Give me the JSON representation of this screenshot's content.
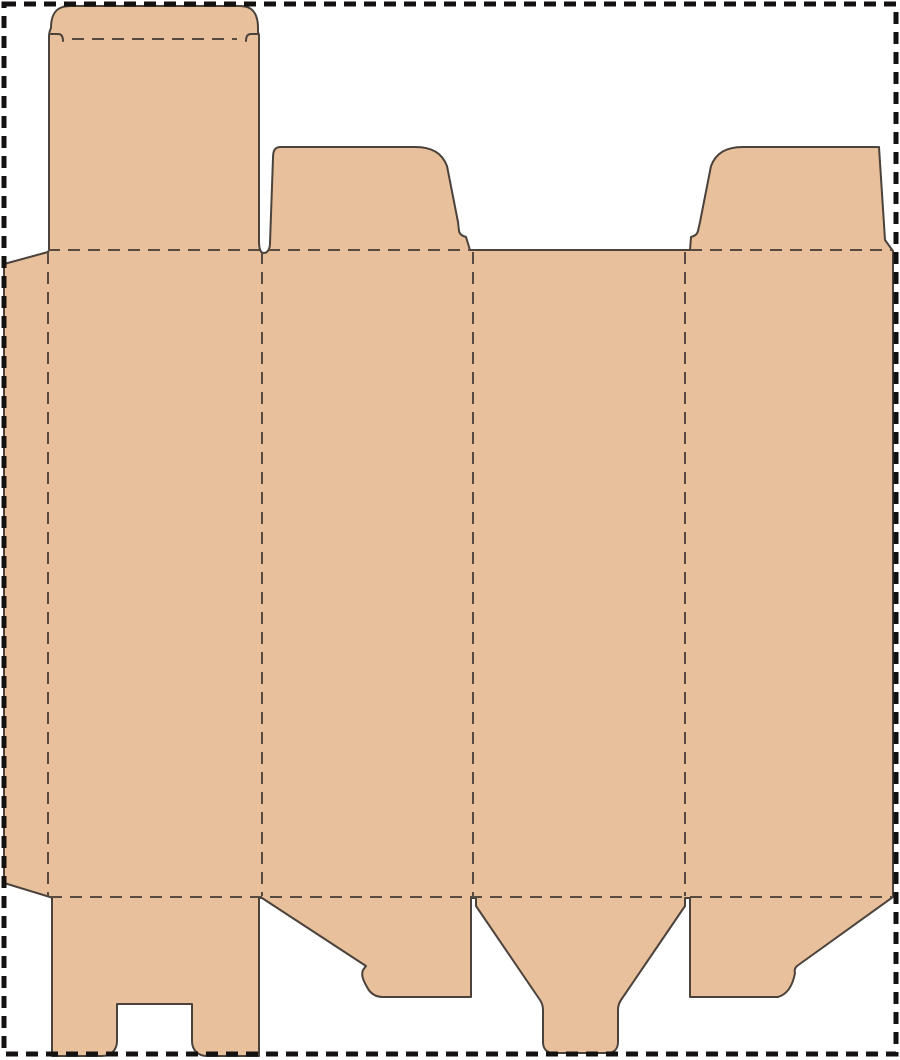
{
  "canvas": {
    "width_px": 900,
    "height_px": 1060,
    "background": "#ffffff"
  },
  "colors": {
    "board_fill": "#e8c09c",
    "cut_line": "#4b423c",
    "fold_line": "#574a40",
    "page_border": "#141210",
    "canvas_bg": "#ffffff"
  },
  "diagram": {
    "type": "packaging-dieline",
    "description": "Flat die-cut template (dieline) of a tuck-top carton blank: tan board silhouette with solid cut lines, dashed fold/crease lines, and a thick dashed black artboard border. No text labels.",
    "line_styles": {
      "cut": "solid dark 2px outline",
      "fold": "dashed dark 2px (12 on / 8 off)",
      "border": "dashed black 5px rectangle around page"
    },
    "structure": {
      "top_row": [
        "tuck-top flap with rounded tuck tab and two lock slits (above panel 1)",
        "dust flap with rounded outer corner and lock notch (above panel 2)",
        "no flap above panel 3 (solid cut top edge)",
        "dust flap mirrored (above panel 4, foot reaching panel edge)"
      ],
      "middle_row": [
        "glue flap (left, slanted top and bottom cuts)",
        "panel 1",
        "panel 2",
        "panel 3",
        "panel 4"
      ],
      "bottom_row": [
        "back flap with central rectangular notch, reaching page bottom (below panel 1)",
        "snap-lock flap with diagonal cut and small lock step (below panel 2)",
        "funnel flap tapering to rounded center tongue reaching page bottom (below panel 3)",
        "snap-lock flap mirrored (below panel 4)"
      ],
      "vertical_fold_x_px": [
        48,
        262,
        473,
        685
      ],
      "horizontal_fold_y_px": [
        250,
        897
      ],
      "tuck_fold_y_px": 39,
      "blank_right_edge_x_px": 893
    }
  }
}
